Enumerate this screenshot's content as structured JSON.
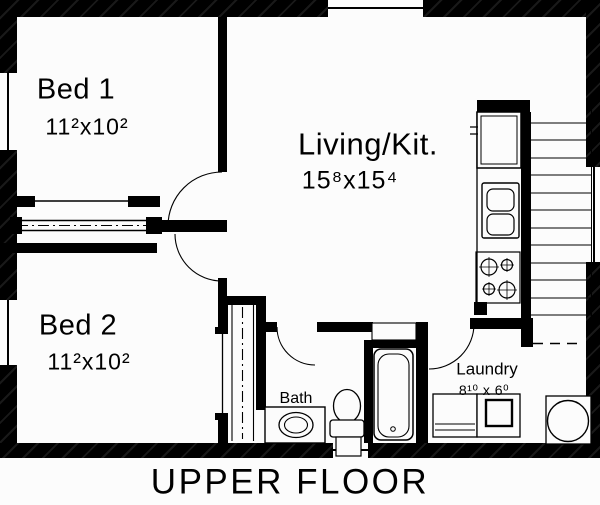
{
  "title": "UPPER FLOOR",
  "colors": {
    "wall": "#000000",
    "background": "#fcfcfc",
    "line": "#000000"
  },
  "rooms": {
    "bed1": {
      "label": "Bed 1",
      "dims": "11²x10²"
    },
    "bed2": {
      "label": "Bed 2",
      "dims": "11²x10²"
    },
    "living": {
      "label": "Living/Kit.",
      "dims": "15⁸x15⁴"
    },
    "bath": {
      "label": "Bath"
    },
    "laundry": {
      "label": "Laundry",
      "dims": "8¹⁰ x 6⁰"
    }
  },
  "fixtures": [
    "refrigerator",
    "kitchen-sink",
    "stove",
    "stairs",
    "bathtub",
    "toilet",
    "vanity-sink",
    "washer",
    "dryer",
    "utility-sink",
    "bed1-closet-sliding-doors",
    "bed2-closet-sliding-doors",
    "linen-niche"
  ]
}
